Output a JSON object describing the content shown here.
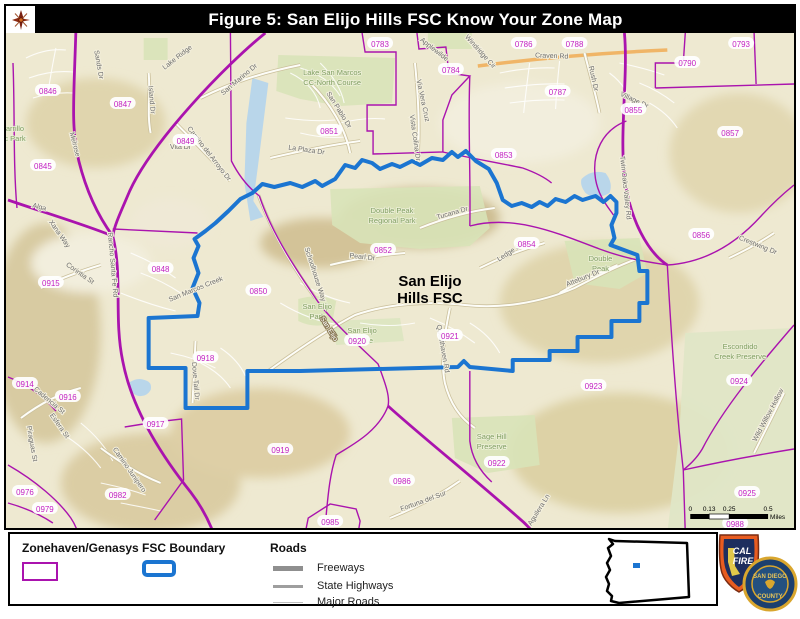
{
  "title": "Figure 5: San Elijo Hills FSC Know Your Zone Map",
  "colors": {
    "title_bg": "#000000",
    "title_text": "#ffffff",
    "zone_line": "#aa13ae",
    "zone_text": "#c21fc2",
    "fsc": "#1b75d1",
    "map_bg": "#eee9d1",
    "water": "#b9d6ea",
    "street_text": "#6e6e6e",
    "area_text": "#7f9e60",
    "road_orange": "#f0b567"
  },
  "map": {
    "fsc_label_lines": [
      "San Elijo",
      "Hills FSC"
    ],
    "zones": [
      {
        "label": "0846",
        "x": 47,
        "y": 88
      },
      {
        "label": "0847",
        "x": 122,
        "y": 101
      },
      {
        "label": "0845",
        "x": 42,
        "y": 163
      },
      {
        "label": "0849",
        "x": 185,
        "y": 138
      },
      {
        "label": "0783",
        "x": 380,
        "y": 41
      },
      {
        "label": "0784",
        "x": 451,
        "y": 67
      },
      {
        "label": "0786",
        "x": 524,
        "y": 41
      },
      {
        "label": "0788",
        "x": 575,
        "y": 41
      },
      {
        "label": "0787",
        "x": 558,
        "y": 89
      },
      {
        "label": "0790",
        "x": 688,
        "y": 60
      },
      {
        "label": "0793",
        "x": 742,
        "y": 41
      },
      {
        "label": "0851",
        "x": 329,
        "y": 128
      },
      {
        "label": "0853",
        "x": 504,
        "y": 152
      },
      {
        "label": "0855",
        "x": 634,
        "y": 107
      },
      {
        "label": "0857",
        "x": 731,
        "y": 130
      },
      {
        "label": "0856",
        "x": 702,
        "y": 232
      },
      {
        "label": "0854",
        "x": 527,
        "y": 241
      },
      {
        "label": "0852",
        "x": 383,
        "y": 247
      },
      {
        "label": "0850",
        "x": 258,
        "y": 288
      },
      {
        "label": "0848",
        "x": 160,
        "y": 266
      },
      {
        "label": "0915",
        "x": 50,
        "y": 280
      },
      {
        "label": "0918",
        "x": 205,
        "y": 355
      },
      {
        "label": "0914",
        "x": 24,
        "y": 381
      },
      {
        "label": "0916",
        "x": 67,
        "y": 394
      },
      {
        "label": "0917",
        "x": 155,
        "y": 421
      },
      {
        "label": "0919",
        "x": 280,
        "y": 447
      },
      {
        "label": "0920",
        "x": 357,
        "y": 338
      },
      {
        "label": "0921",
        "x": 450,
        "y": 333
      },
      {
        "label": "0922",
        "x": 497,
        "y": 460
      },
      {
        "label": "0923",
        "x": 594,
        "y": 383
      },
      {
        "label": "0924",
        "x": 740,
        "y": 378
      },
      {
        "label": "0925",
        "x": 748,
        "y": 490
      },
      {
        "label": "0988",
        "x": 736,
        "y": 521
      },
      {
        "label": "0976",
        "x": 24,
        "y": 489
      },
      {
        "label": "0979",
        "x": 44,
        "y": 506
      },
      {
        "label": "0982",
        "x": 117,
        "y": 492
      },
      {
        "label": "0985",
        "x": 330,
        "y": 519
      },
      {
        "label": "0986",
        "x": 402,
        "y": 478
      }
    ],
    "streets": [
      {
        "label": "Lake Ridge",
        "x": 178,
        "y": 56,
        "r": -38
      },
      {
        "label": "San Marino Dr",
        "x": 240,
        "y": 78,
        "r": -40
      },
      {
        "label": "Sands Dr",
        "x": 96,
        "y": 62,
        "r": 80
      },
      {
        "label": "Island Dr",
        "x": 149,
        "y": 97,
        "r": 85
      },
      {
        "label": "Melrose",
        "x": 72,
        "y": 142,
        "r": 75
      },
      {
        "label": "Camino del Arroyo Dr",
        "x": 207,
        "y": 152,
        "r": 52
      },
      {
        "label": "Vita Dr",
        "x": 180,
        "y": 146,
        "r": 0
      },
      {
        "label": "Alga",
        "x": 38,
        "y": 206,
        "r": 14
      },
      {
        "label": "Xana Way",
        "x": 57,
        "y": 232,
        "r": 55
      },
      {
        "label": "Corintia St",
        "x": 78,
        "y": 272,
        "r": 35
      },
      {
        "label": "Rancho Santa Fe Rd",
        "x": 110,
        "y": 262,
        "r": 85
      },
      {
        "label": "San Pablo Dr",
        "x": 337,
        "y": 108,
        "r": 58
      },
      {
        "label": "La Plaza Dr",
        "x": 306,
        "y": 149,
        "r": 8
      },
      {
        "label": "Via Vera Cruz",
        "x": 421,
        "y": 98,
        "r": 78
      },
      {
        "label": "Vista Colina Dr",
        "x": 413,
        "y": 135,
        "r": 82
      },
      {
        "label": "Applewilde",
        "x": 433,
        "y": 48,
        "r": 38
      },
      {
        "label": "Windridge Cir",
        "x": 479,
        "y": 50,
        "r": 48
      },
      {
        "label": "Craven Rd",
        "x": 552,
        "y": 55,
        "r": 2
      },
      {
        "label": "Rush Dr",
        "x": 592,
        "y": 76,
        "r": 78
      },
      {
        "label": "Village Dr",
        "x": 634,
        "y": 99,
        "r": 25
      },
      {
        "label": "Twin Oaks Valley Rd",
        "x": 624,
        "y": 185,
        "r": 84
      },
      {
        "label": "Tucana Dr",
        "x": 453,
        "y": 212,
        "r": -16
      },
      {
        "label": "Pearl Dr",
        "x": 362,
        "y": 256,
        "r": 6
      },
      {
        "label": "Schoolhouse Way",
        "x": 313,
        "y": 272,
        "r": 72
      },
      {
        "label": "Ledge St",
        "x": 511,
        "y": 251,
        "r": -33
      },
      {
        "label": "Attebury Dr",
        "x": 584,
        "y": 277,
        "r": -22
      },
      {
        "label": "Crestwing Dr",
        "x": 758,
        "y": 244,
        "r": 22
      },
      {
        "label": "Questhaven Rd",
        "x": 441,
        "y": 346,
        "r": 80
      },
      {
        "label": "San Elijo",
        "x": 327,
        "y": 327,
        "r": 58,
        "on_road": true
      },
      {
        "label": "Dove Tail Dr",
        "x": 193,
        "y": 378,
        "r": 85
      },
      {
        "label": "San Marcos Creek",
        "x": 196,
        "y": 288,
        "r": -22
      },
      {
        "label": "Cadencia St",
        "x": 47,
        "y": 399,
        "r": 40
      },
      {
        "label": "Esfera St",
        "x": 57,
        "y": 424,
        "r": 55
      },
      {
        "label": "Piraguas St",
        "x": 29,
        "y": 441,
        "r": 80
      },
      {
        "label": "Camino Junipero",
        "x": 127,
        "y": 468,
        "r": 55
      },
      {
        "label": "Fortuna del Sur",
        "x": 424,
        "y": 500,
        "r": -20
      },
      {
        "label": "Wild Willow Hollow",
        "x": 771,
        "y": 413,
        "r": -62
      },
      {
        "label": "Aguilera Ln",
        "x": 541,
        "y": 508,
        "r": -58
      }
    ],
    "areas": [
      {
        "lines": [
          "Lake San Marcos",
          "CC-North Course"
        ],
        "x": 332,
        "y": 72
      },
      {
        "lines": [
          "Double Peak",
          "Regional Park"
        ],
        "x": 392,
        "y": 210
      },
      {
        "lines": [
          "Double",
          "Peak"
        ],
        "x": 601,
        "y": 258
      },
      {
        "lines": [
          "San Elijo",
          "Park"
        ],
        "x": 317,
        "y": 306
      },
      {
        "lines": [
          "San Elijo",
          "Middle"
        ],
        "x": 362,
        "y": 330
      },
      {
        "lines": [
          "Sage Hill",
          "Preserve"
        ],
        "x": 492,
        "y": 436
      },
      {
        "lines": [
          "Escondido",
          "Creek Preserve"
        ],
        "x": 741,
        "y": 346
      },
      {
        "lines": [
          "arrillo",
          "c Park"
        ],
        "x": 14,
        "y": 128
      }
    ],
    "scale": {
      "ticks": [
        {
          "label": "0",
          "x": 691
        },
        {
          "label": "0.13",
          "x": 710
        },
        {
          "label": "0.25",
          "x": 730
        },
        {
          "label": "0.5",
          "x": 769
        }
      ],
      "unit": "Miles"
    }
  },
  "legend": {
    "zonehaven": "Zonehaven/Genasys",
    "fsc": "FSC Boundary",
    "roads": "Roads",
    "road_types": [
      "Freeways",
      "State Highways",
      "Major Roads"
    ]
  },
  "logos": {
    "calfire_line1": "CAL",
    "calfire_line2": "FIRE",
    "county_top": "SAN DIEGO",
    "county_bottom": "COUNTY"
  }
}
